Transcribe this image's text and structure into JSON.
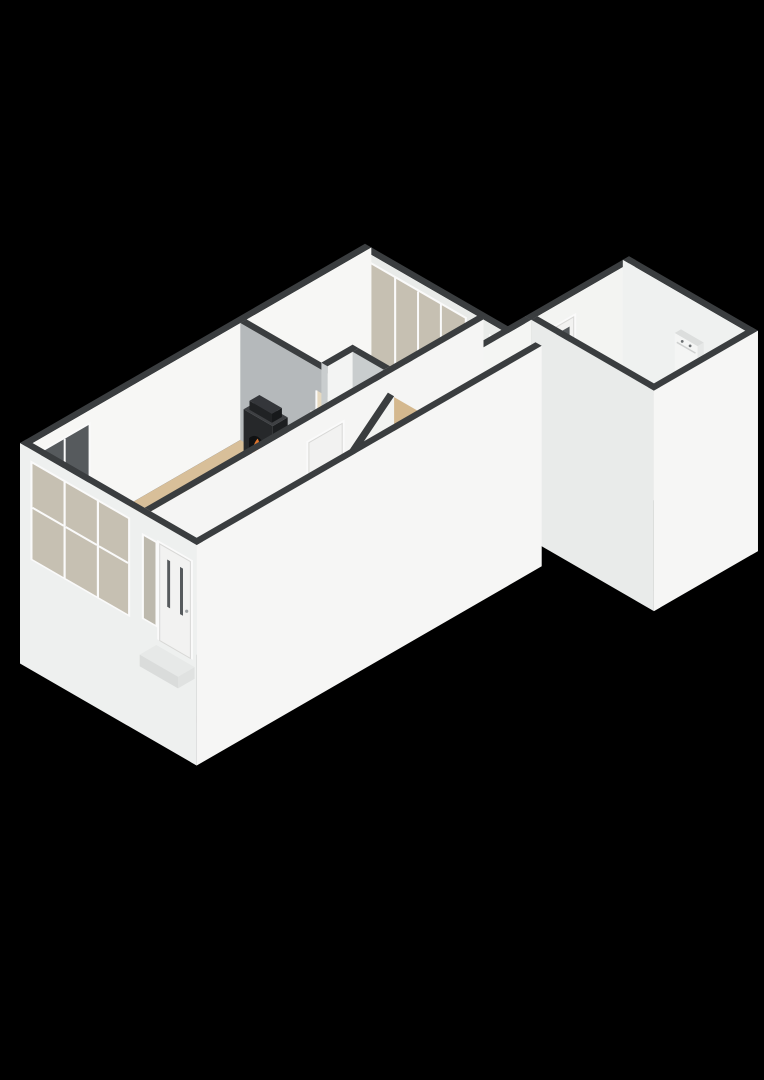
{
  "app": {
    "name": "3d-floor-plan-viewer",
    "view": "isometric-3d-ground-floor",
    "background": "#000000"
  },
  "palette": {
    "background": "#000000",
    "wall_top": "#3a3d3f",
    "wall_face_bright": "#f6f6f5",
    "wall_face_exterior": "#eef0ef",
    "wall_face_interior_shade": "#d6dadb",
    "wall_face_gray": "#b5b9bb",
    "floor_wood": "#d8bf99",
    "floor_wood_shade": "#d4b88e",
    "floor_white": "#eff0ee",
    "floor_hall": "#ebecea",
    "floor_blue": "#ccd4da",
    "glass_hazy": "#c6c0b2",
    "glass_cool": "#ced6da",
    "glass_dark": "#565a5d",
    "frame_white": "#fafafa",
    "door_white": "#f2f2f1",
    "stove_black": "#26282a",
    "flame_orange": "#e0762e",
    "flame_red": "#c03a26",
    "open_doorway": "#e6d9c0"
  },
  "rooms": [
    {
      "id": "living-room",
      "floor": "floor_wood"
    },
    {
      "id": "dining-room",
      "floor": "floor_wood"
    },
    {
      "id": "entrance-hall",
      "floor": "floor_hall"
    },
    {
      "id": "toilet",
      "floor": "floor_white"
    },
    {
      "id": "bathroom",
      "floor": "floor_blue"
    },
    {
      "id": "storage-room",
      "floor": "floor_white"
    }
  ],
  "features": [
    "bay-windows",
    "side-window",
    "front-door",
    "porch-step",
    "hall-door",
    "open-door-dining",
    "closet",
    "fireplace",
    "french-doors-dining",
    "bathroom-window",
    "staircase",
    "courtyard-wall",
    "storage-door",
    "boiler-unit"
  ]
}
